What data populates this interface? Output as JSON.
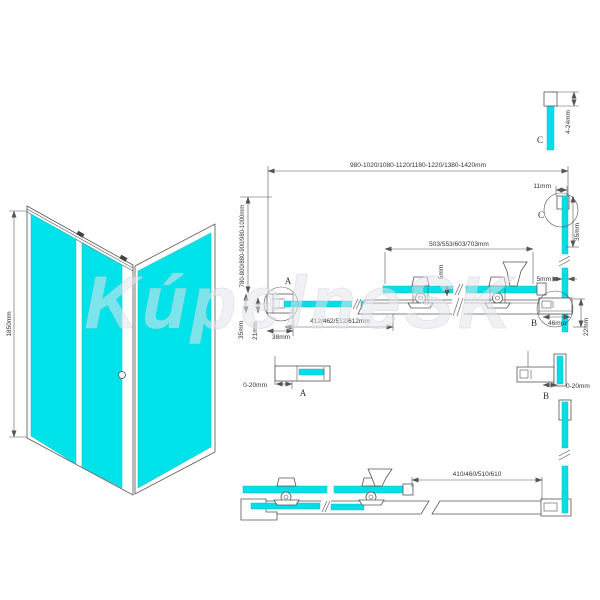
{
  "watermark": {
    "text": "KúpelneSK"
  },
  "view3d": {
    "height": "1850mm"
  },
  "top_view": {
    "total_width": "980-1020/1080-1120/1180-1220/1380-1420mm",
    "side_depth": "780-800/880-900/980-1000mm"
  },
  "rail_section": {
    "roller_spacing": "503/553/603/703mm",
    "glass_overlap_left": "5mm",
    "glass_gap_right": "5mm",
    "fixed_glass_width": "412/462/512/612mm"
  },
  "bottom_section": {
    "fixed_glass_width": "410/460/510/610"
  },
  "detail_a": {
    "label": "A",
    "wall_offset": "35mm",
    "glass_inset": "21mm",
    "profile_width": "38mm",
    "adjust_range": "0-20mm"
  },
  "detail_b": {
    "label": "B",
    "profile_width": "46mm",
    "profile_height": "22mm",
    "adjust_range": "0-20mm"
  },
  "detail_c": {
    "label": "C",
    "adjust_range": "4-24mm",
    "profile_width": "11mm",
    "glass_depth": "35mm"
  },
  "colors": {
    "glass": "#00dfe8",
    "line": "#555555"
  }
}
